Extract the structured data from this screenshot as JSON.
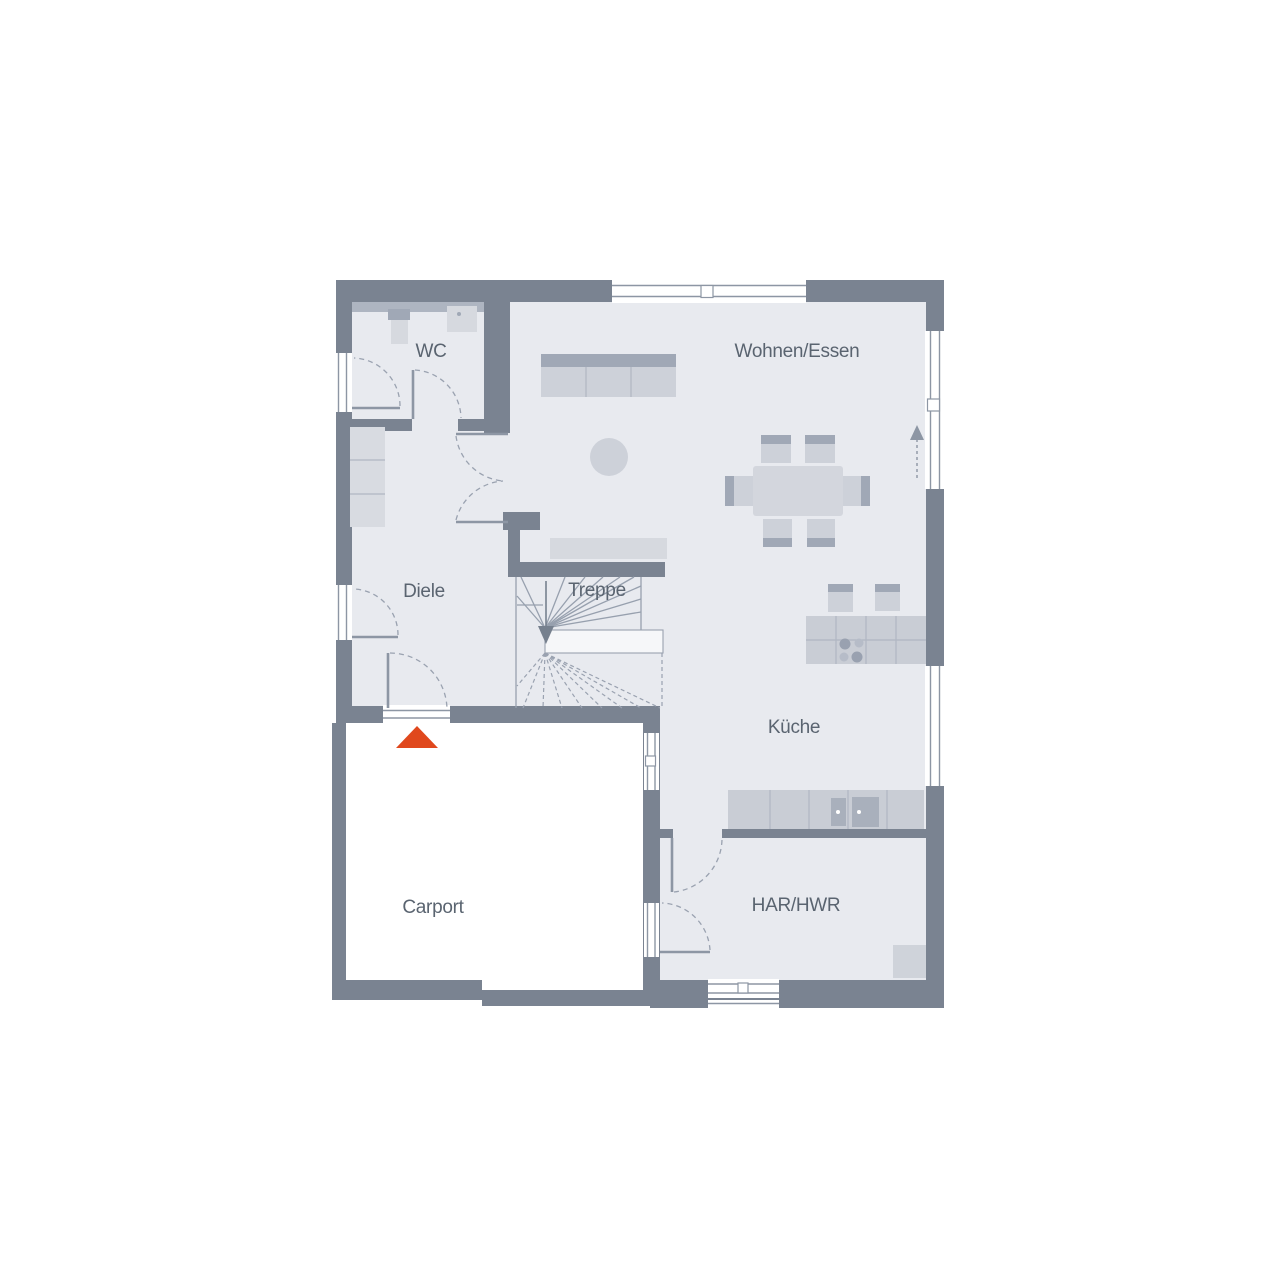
{
  "floorplan": {
    "rooms": [
      {
        "id": "wc",
        "label": "WC"
      },
      {
        "id": "wohnen_essen",
        "label": "Wohnen/Essen"
      },
      {
        "id": "diele",
        "label": "Diele"
      },
      {
        "id": "treppe",
        "label": "Treppe"
      },
      {
        "id": "kueche",
        "label": "Küche"
      },
      {
        "id": "carport",
        "label": "Carport"
      },
      {
        "id": "har_hwr",
        "label": "HAR/HWR"
      }
    ],
    "colors": {
      "wall": "#7a8391",
      "floor": "#e8eaef",
      "furniture_light": "#cdd1d9",
      "furniture_dark": "#a0a8b6",
      "entrance_marker": "#e0481d",
      "label_text": "#5a6470"
    }
  }
}
